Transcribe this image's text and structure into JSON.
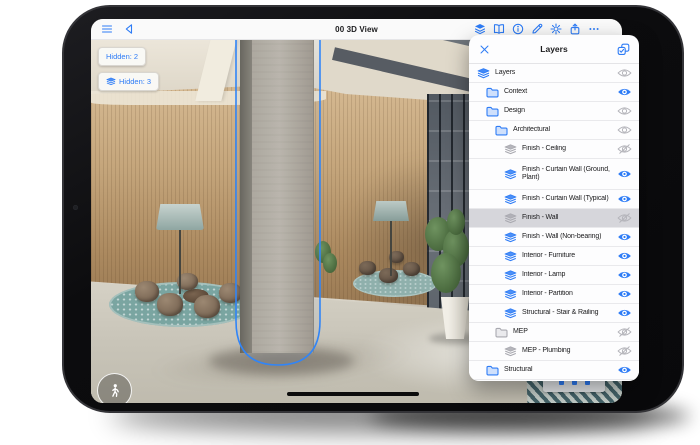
{
  "toolbar": {
    "title": "00 3D View",
    "left_icons": [
      {
        "icon": "menu",
        "name": "menu-icon"
      },
      {
        "icon": "back",
        "name": "back-icon"
      }
    ],
    "right_icons": [
      {
        "icon": "layers-filled",
        "name": "layers-panel-toggle-icon",
        "active": true
      },
      {
        "icon": "book",
        "name": "book-icon"
      },
      {
        "icon": "info",
        "name": "info-icon"
      },
      {
        "icon": "pencil",
        "name": "pencil-icon"
      },
      {
        "icon": "settings",
        "name": "settings-gear-icon"
      },
      {
        "icon": "share",
        "name": "share-icon"
      },
      {
        "icon": "more",
        "name": "more-ellipsis-icon"
      }
    ]
  },
  "viewport": {
    "hidden_badges": [
      {
        "label": "Hidden: 2",
        "icon": null
      },
      {
        "label": "Hidden: 3",
        "icon": "layer"
      }
    ],
    "walk_button_icon": "walk",
    "selected_object": "column"
  },
  "layers_panel": {
    "title": "Layers",
    "close_icon": "close",
    "action_icon": "multiselect",
    "rows": [
      {
        "label": "Layers",
        "icon": "layers-root",
        "indent": 0,
        "visibility": "mixed",
        "selected": false
      },
      {
        "label": "Context",
        "icon": "folder",
        "indent": 1,
        "visibility": "visible",
        "selected": false
      },
      {
        "label": "Design",
        "icon": "folder",
        "indent": 1,
        "visibility": "mixed",
        "selected": false
      },
      {
        "label": "Architectural",
        "icon": "folder",
        "indent": 2,
        "visibility": "mixed",
        "selected": false
      },
      {
        "label": "Finish - Ceiling",
        "icon": "layer",
        "indent": 3,
        "visibility": "hidden",
        "selected": false
      },
      {
        "label": "Finish - Curtain Wall (Ground, Plant)",
        "icon": "layer",
        "indent": 3,
        "visibility": "visible",
        "selected": false,
        "two_line": true
      },
      {
        "label": "Finish - Curtain Wall (Typical)",
        "icon": "layer",
        "indent": 3,
        "visibility": "visible",
        "selected": false
      },
      {
        "label": "Finish - Wall",
        "icon": "layer",
        "indent": 3,
        "visibility": "hidden",
        "selected": true
      },
      {
        "label": "Finish - Wall (Non-bearing)",
        "icon": "layer",
        "indent": 3,
        "visibility": "visible",
        "selected": false
      },
      {
        "label": "Interior - Furniture",
        "icon": "layer",
        "indent": 3,
        "visibility": "visible",
        "selected": false
      },
      {
        "label": "Interior - Lamp",
        "icon": "layer",
        "indent": 3,
        "visibility": "visible",
        "selected": false
      },
      {
        "label": "Interior - Partition",
        "icon": "layer",
        "indent": 3,
        "visibility": "visible",
        "selected": false
      },
      {
        "label": "Structural - Stair & Railing",
        "icon": "layer",
        "indent": 3,
        "visibility": "visible",
        "selected": false
      },
      {
        "label": "MEP",
        "icon": "folder",
        "indent": 2,
        "visibility": "hidden",
        "selected": false
      },
      {
        "label": "MEP - Plumbing",
        "icon": "layer",
        "indent": 3,
        "visibility": "hidden",
        "selected": false
      },
      {
        "label": "Structural",
        "icon": "folder",
        "indent": 1,
        "visibility": "visible",
        "selected": false
      }
    ]
  },
  "colors": {
    "accent_blue": "#2e7cf6",
    "hidden_gray": "#a9a9b0",
    "selected_row": "#d6d6db",
    "panel_bg": "#fdfdfe",
    "wood_wall": "#b4906a",
    "rug_teal": "#7aa5a1",
    "device_frame": "#0c0c0e"
  }
}
